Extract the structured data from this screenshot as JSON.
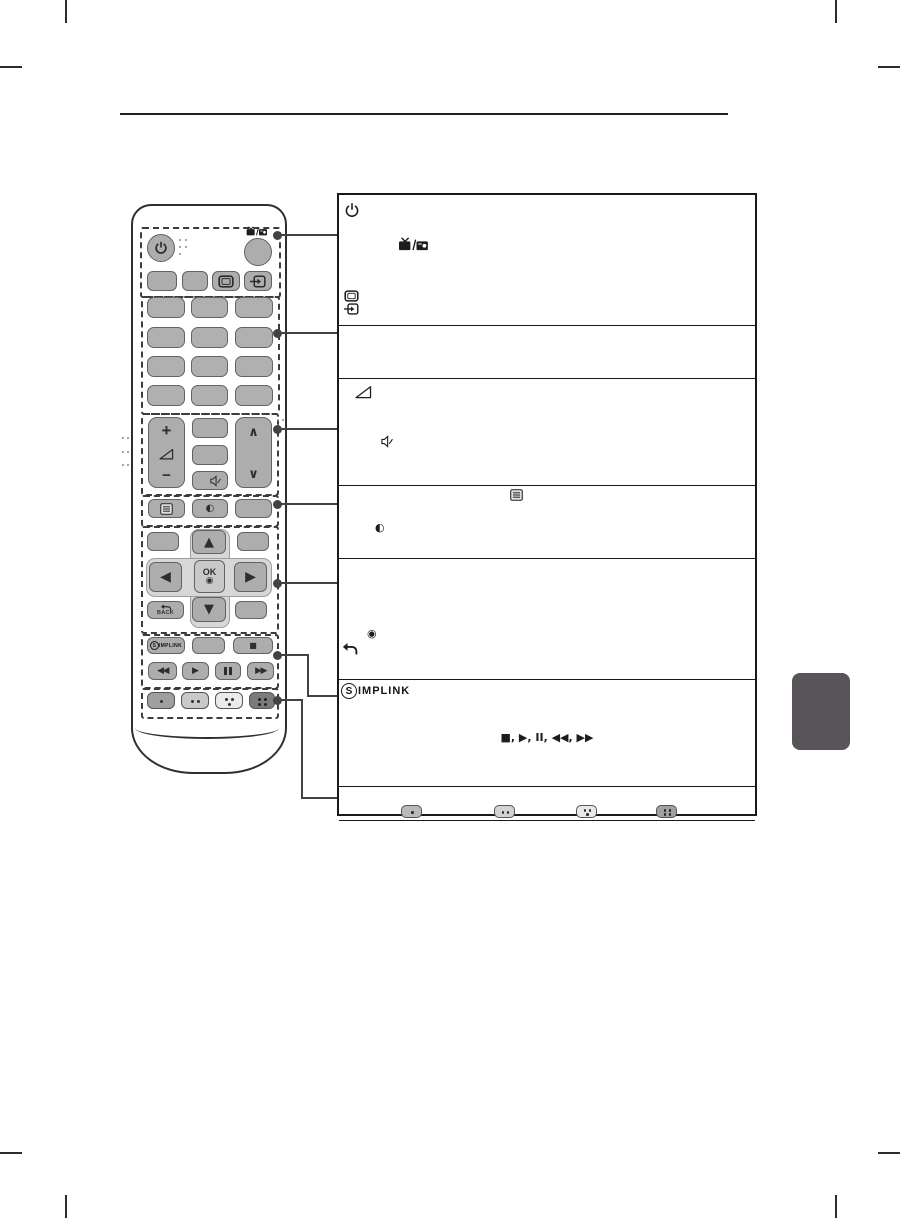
{
  "page": {
    "background": "#ffffff",
    "tab_color": "#585459",
    "rule_color": "#1f1f1f"
  },
  "remote": {
    "volume_up_label": "+",
    "volume_down_label": "−",
    "channel_up_glyph": "∧",
    "channel_down_glyph": "∨",
    "nav_up_glyph": "▲",
    "nav_down_glyph": "▼",
    "nav_left_glyph": "◀",
    "nav_right_glyph": "▶",
    "ok_label": "OK",
    "ok_glyph": "◉",
    "back_label": "BACK",
    "stop_glyph": "■",
    "rewind_glyph": "◀◀",
    "play_glyph": "▶",
    "forward_glyph": "▶▶",
    "qmenu_glyph": "◐",
    "simplink_s": "S",
    "simplink_rest": "IMPLINK"
  },
  "table": {
    "rows": [
      {
        "icons": [
          "power-icon",
          "tv-radio-icon",
          "monitor-icon",
          "input-icon"
        ]
      },
      {
        "icons": []
      },
      {
        "icons": [
          "volume-icon",
          "mute-icon"
        ]
      },
      {
        "icons": [
          "settings-menu-icon",
          "quick-menu-icon"
        ]
      },
      {
        "icons": [
          "ok-target-icon",
          "back-icon"
        ]
      },
      {
        "icons": [
          "simplink-logo",
          "playback-controls"
        ],
        "playback_sequence": "■, ▶, II, ◀◀, ▶▶"
      },
      {
        "icons": [
          "one-dot-key",
          "two-dot-key",
          "three-dot-key",
          "four-dot-key"
        ]
      }
    ],
    "qmenu_glyph": "◐",
    "ok_glyph": "◉",
    "simplink_s": "S",
    "simplink_rest": "IMPLINK"
  }
}
